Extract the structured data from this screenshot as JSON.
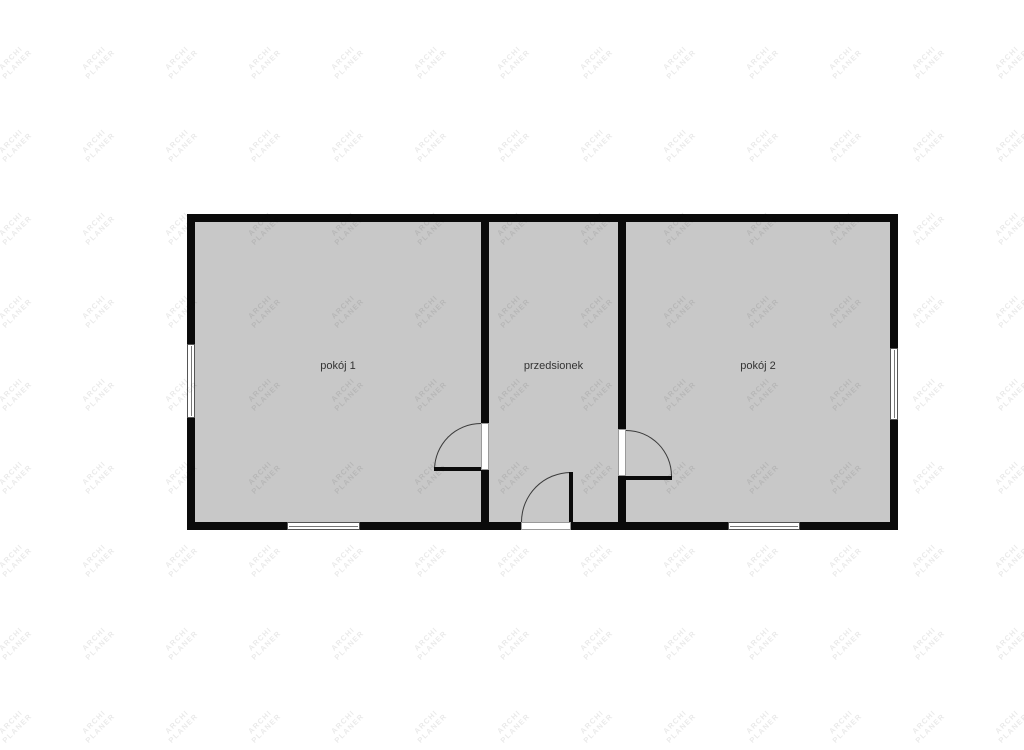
{
  "watermark": {
    "line1": "ARCHI",
    "line2": "PLANER",
    "color": "rgba(0,0,0,0.085)",
    "grid": {
      "start_x": 14,
      "start_y": 63,
      "spacing_x": 83,
      "spacing_y": 83,
      "cols": 13,
      "rows": 9,
      "rotation_deg": -45
    }
  },
  "floor_plan": {
    "rooms": [
      {
        "id": "pokoj-1",
        "label": "pokój 1"
      },
      {
        "id": "przedsionek",
        "label": "przedsionek"
      },
      {
        "id": "pokoj-2",
        "label": "pokój 2"
      }
    ],
    "colors": {
      "wall": "#0a0a0a",
      "floor": "#c8c8c8",
      "background": "#ffffff",
      "door_arc": "#3a3a3a",
      "window_border": "#555555",
      "label_text": "#333333"
    }
  }
}
